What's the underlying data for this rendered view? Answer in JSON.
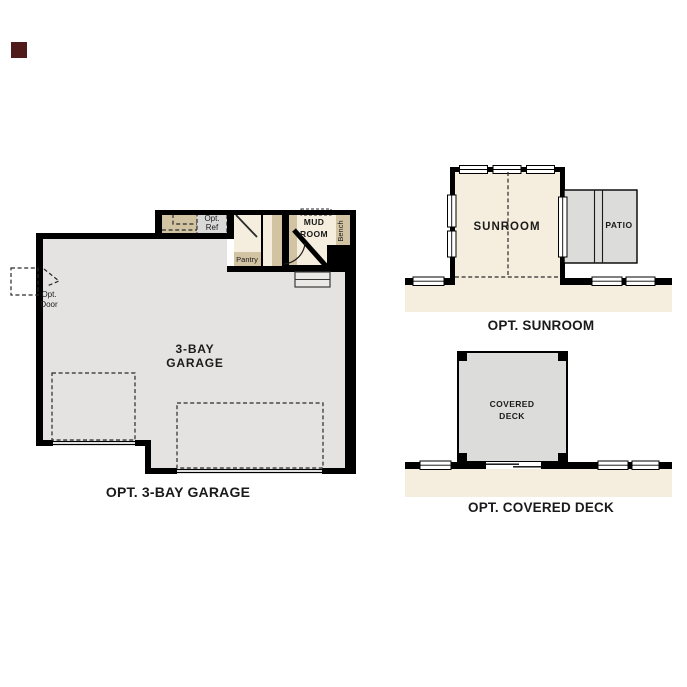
{
  "colors": {
    "wall": "#000000",
    "floor": "#e4e3e1",
    "cream": "#f5eede",
    "tan": "#d2c3a3",
    "concrete": "#dcdcdb",
    "stoop": "#eae9e6",
    "opt_ref_fill": "#d9d9d9",
    "marker": "#4f1b1b",
    "text": "#1a1a1a"
  },
  "garage": {
    "room_label": {
      "line1": "3-BAY",
      "line2": "GARAGE"
    },
    "caption": "OPT. 3-BAY GARAGE",
    "opt_ref": {
      "line1": "Opt.",
      "line2": "Ref"
    },
    "pantry": "Pantry",
    "mud_room": {
      "line1": "MUD",
      "line2": "ROOM"
    },
    "bench": "Bench",
    "opt_door": {
      "line1": "Opt.",
      "line2": "Door"
    }
  },
  "sunroom": {
    "room": "SUNROOM",
    "patio": "PATIO",
    "caption": "OPT. SUNROOM"
  },
  "covered_deck": {
    "room": {
      "line1": "COVERED",
      "line2": "DECK"
    },
    "caption": "OPT. COVERED DECK"
  }
}
